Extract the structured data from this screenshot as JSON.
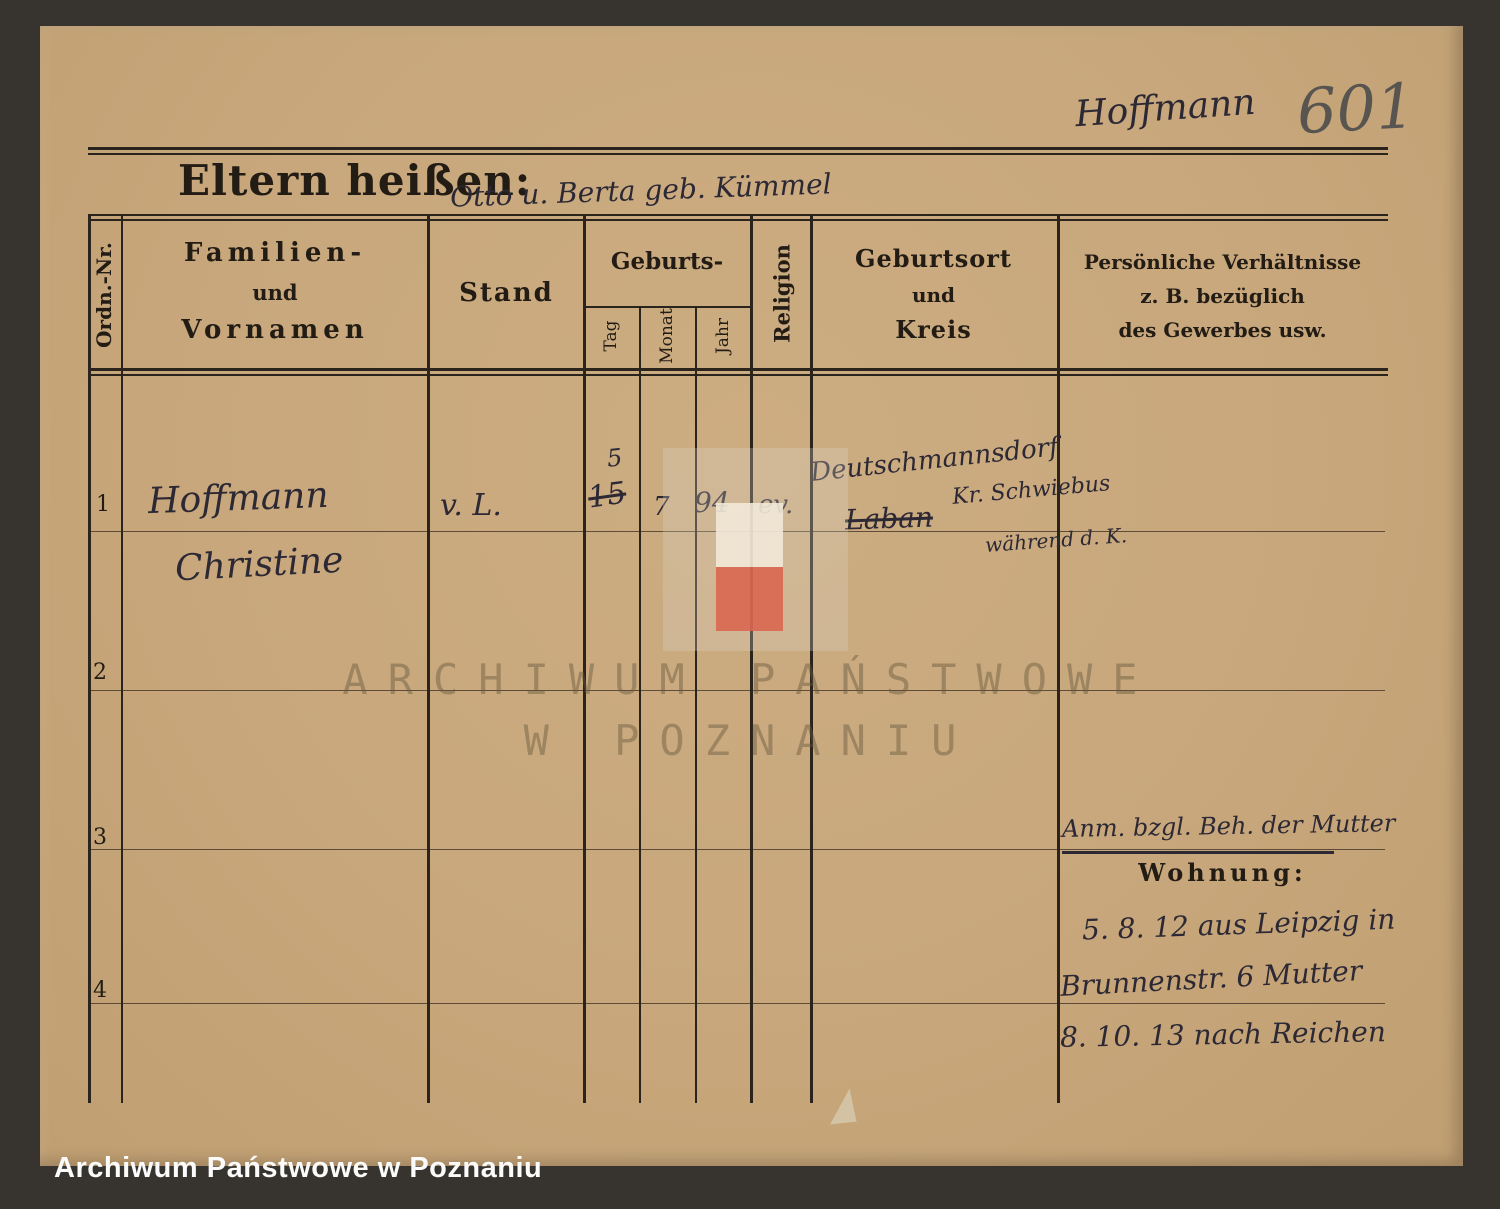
{
  "header": {
    "surname_annotation": "Hoffmann",
    "page_number": "601"
  },
  "form_title": {
    "label": "Eltern heißen:",
    "value": "Otto u. Berta geb. Kümmel"
  },
  "table": {
    "columns": {
      "ordnr": "Ordn.-Nr.",
      "name": [
        "Familien-",
        "und",
        "Vornamen"
      ],
      "stand": "Stand",
      "geburts": "Geburts-",
      "geburts_sub": [
        "Tag",
        "Monat",
        "Jahr"
      ],
      "religion": "Religion",
      "geburtsort": [
        "Geburtsort",
        "und",
        "Kreis"
      ],
      "verhaeltnisse": [
        "Persönliche Verhältnisse",
        "z. B. bezüglich",
        "des Gewerbes usw."
      ]
    },
    "row_numbers": [
      "1",
      "2",
      "3",
      "4"
    ],
    "row1": {
      "name_line1": "Hoffmann",
      "name_line2": "Christine",
      "stand": "v. L.",
      "tag_struck": "15",
      "tag_corrected": "5",
      "monat": "7",
      "jahr": "94",
      "religion": "ev.",
      "geburtsort_line1": "Deutschmannsdorf",
      "geburtsort_struck": "Laban",
      "geburtsort_line2": "Kr. Schwiebus",
      "geburtsort_line3": "während d. K."
    },
    "right_column": {
      "note": "Anm. bzgl. Beh. der Mutter",
      "wohnung_label": "Wohnung:",
      "wohnung_line1": "5. 8. 12 aus Leipzig in",
      "wohnung_line2": "Brunnenstr. 6  Mutter",
      "wohnung_line3": "8. 10. 13 nach Reichen"
    }
  },
  "watermark": {
    "line1": "ARCHIWUM PAŃSTWOWE",
    "line2": "W POZNANIU"
  },
  "footer": {
    "label": "Archiwum Państwowe w Poznaniu"
  },
  "colors": {
    "paper": "#c7a77b",
    "background": "#37332e",
    "ink": "#2c2834",
    "printed": "#221c15",
    "pencil": "#585450",
    "logo_white": "#f2ead9",
    "logo_red": "#d96450"
  }
}
